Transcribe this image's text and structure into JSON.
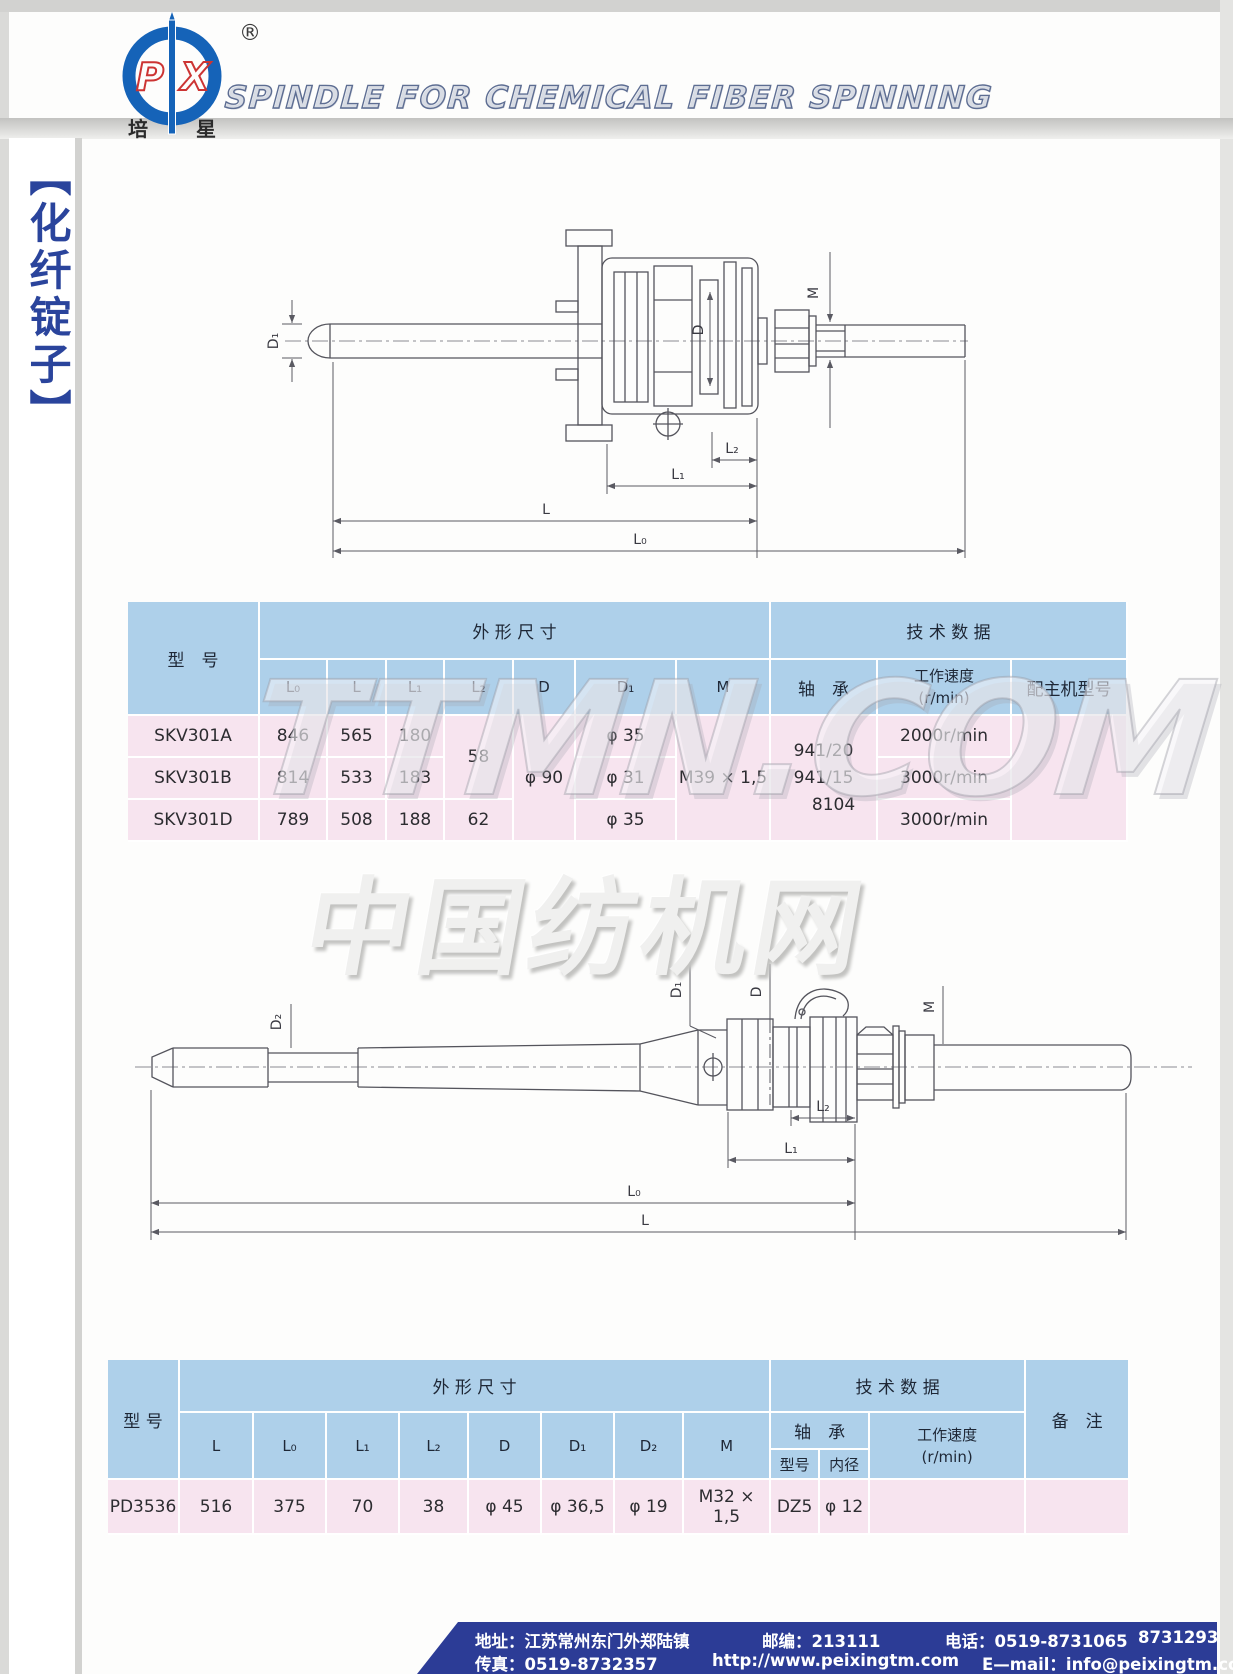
{
  "header": {
    "title": "SPINDLE FOR CHEMICAL FIBER SPINNING",
    "logo": {
      "letter_p": "P",
      "letter_x": "X",
      "registered": "®",
      "cn_left": "培",
      "cn_right": "星"
    }
  },
  "sidebar": {
    "label": "【化纤锭子】"
  },
  "watermarks": {
    "ttmn": "TTMN.COM",
    "cftm": "中国纺机网"
  },
  "drawing1": {
    "labels": {
      "d1": "D₁",
      "d": "D",
      "m": "M",
      "l2": "L₂",
      "l1": "L₁",
      "l": "L",
      "l0": "L₀"
    }
  },
  "drawing2": {
    "labels": {
      "d2": "D₂",
      "d1": "D₁",
      "d": "D",
      "m": "M",
      "l2": "L₂",
      "l1": "L₁",
      "l0": "L₀",
      "l": "L"
    }
  },
  "table1": {
    "header": {
      "model": "型　号",
      "dims": "外 形 尺 寸",
      "tech": "技 术 数 据",
      "cols": [
        "L₀",
        "L",
        "L₁",
        "L₂",
        "D",
        "D₁",
        "M"
      ],
      "bearing": "轴　承",
      "speed_line1": "工作速度",
      "speed_line2": "(r/min)",
      "host": "配主机型号"
    },
    "merged": {
      "l2_ab": "58",
      "d": "φ 90",
      "m": "M39 × 1,5",
      "bearing": [
        "941/20",
        "941/15",
        "8104"
      ],
      "host": ""
    },
    "rows": [
      {
        "model": "SKV301A",
        "l0": "846",
        "l": "565",
        "l1": "180",
        "d1": "φ 35",
        "speed": "2000r/min"
      },
      {
        "model": "SKV301B",
        "l0": "814",
        "l": "533",
        "l1": "183",
        "d1": "φ 31",
        "speed": "3000r/min"
      },
      {
        "model": "SKV301D",
        "l0": "789",
        "l": "508",
        "l1": "188",
        "l2": "62",
        "d1": "φ 35",
        "speed": "3000r/min"
      }
    ]
  },
  "table2": {
    "header": {
      "model": "型 号",
      "dims": "外 形 尺 寸",
      "tech": "技 术 数 据",
      "remark": "备　注",
      "cols": [
        "L",
        "L₀",
        "L₁",
        "L₂",
        "D",
        "D₁",
        "D₂",
        "M"
      ],
      "bearing": "轴　承",
      "bearing_model": "型号",
      "bearing_bore": "内径",
      "speed_line1": "工作速度",
      "speed_line2": "(r/min)"
    },
    "row": {
      "model": "PD3536",
      "l": "516",
      "l0": "375",
      "l1": "70",
      "l2": "38",
      "d": "φ 45",
      "d1": "φ 36,5",
      "d2": "φ 19",
      "m": "M32 × 1,5",
      "bz_model": "DZ5",
      "bz_bore": "φ 12",
      "speed": "",
      "remark": ""
    }
  },
  "footer": {
    "address": "地址：江苏常州东门外郑陆镇",
    "zip": "邮编：213111",
    "tel": "电话：0519-8731065",
    "tel2": "8731293",
    "fax": "传真：0519-8732357",
    "web": "http://www.peixingtm.com",
    "email": "E—mail：info@peixingtm.com"
  },
  "colors": {
    "table_header_blue": "#aed0ea",
    "table_row_pink": "#f7e4ef",
    "footer_blue": "#2c3c96",
    "logo_blue": "#1563b8",
    "logo_red": "#cc3433",
    "sidebar_blue": "#2a449c"
  }
}
